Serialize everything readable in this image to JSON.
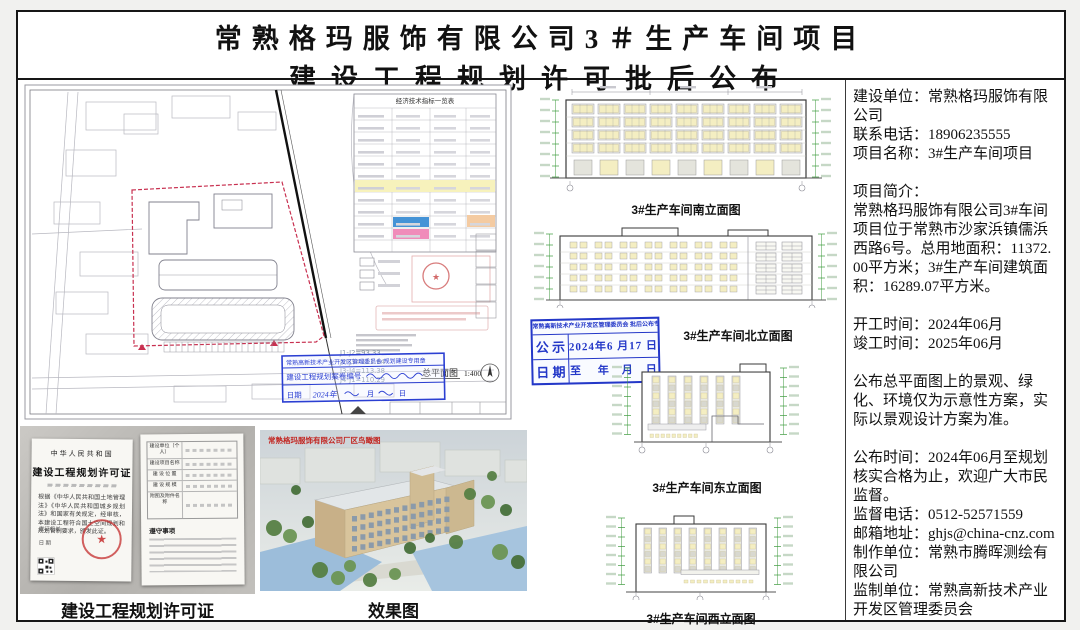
{
  "title": {
    "line1": "常熟格玛服饰有限公司3＃生产车间项目",
    "line2": "建设工程规划许可批后公布"
  },
  "site_plan": {
    "table_title": "经济技术指标一览表",
    "plan_title": "总平面图",
    "plan_scale": "1:400",
    "boundary_dims": [
      "J1-J2=93.33",
      "J2-J3=111.64",
      "J3-J4=113.38",
      "J4-J1=110.29"
    ],
    "blue_stamp": {
      "header": "常熟高新技术产业开发区管理委员会 规划建设专用章",
      "case_label": "建设工程规划案卷编号",
      "date_label": "日期",
      "date_year": "2024年",
      "date_month": "月",
      "date_day": "日"
    }
  },
  "elevations": {
    "south": "3#生产车间南立面图",
    "north": "3#生产车间北立面图",
    "east": "3#生产车间东立面图",
    "west": "3#生产车间西立面图"
  },
  "notice_stamp": {
    "header": "常熟高新技术产业开发区管理委员会 批后公布专用章",
    "r1c1": "公 示",
    "r1c2": "2024年6 月17 日",
    "r2c1": "日 期",
    "r2c2": "至　 年　月　日"
  },
  "certificate": {
    "caption": "建设工程规划许可证",
    "country": "中华人民共和国",
    "doc_title": "建设工程规划许可证",
    "body": "根据《中华人民共和国土地管理法》《中华人民共和国城乡规划法》和国家有关规定，经审核，本建设工程符合国土空间规划和规划管制要求，颁发此证。",
    "issue_label": "发证机关",
    "date_label": "日  期",
    "right_rows": [
      "建设单位（个人）",
      "建设项目名称",
      "建 设 位 置",
      "建 设 规 模",
      "附图及附件名称"
    ],
    "section2": "遵守事项",
    "seal_star": "★"
  },
  "rendering": {
    "caption": "效果图",
    "watermark": "常熟格玛服饰有限公司厂区鸟瞰图"
  },
  "info_panel": {
    "lines": [
      "建设单位：常熟格玛服饰有限公司",
      "联系电话：18906235555",
      "项目名称：3#生产车间项目",
      "",
      "项目简介：",
      "常熟格玛服饰有限公司3#车间项目位于常熟市沙家浜镇儒浜西路6号。总用地面积：11372.00平方米；3#生产车间建筑面积：16289.07平方米。",
      "",
      "开工时间：2024年06月",
      "竣工时间：2025年06月",
      "",
      "公布总平面图上的景观、绿化、环境仅为示意性方案，实际以景观设计方案为准。",
      "",
      "公布时间：2024年06月至规划核实合格为止，欢迎广大市民监督。",
      "监督电话：0512-52571559",
      "邮箱地址：ghjs@china-cnz.com",
      "制作单位：常熟市腾晖测绘有限公司",
      "监制单位：常熟高新技术产业开发区管理委员会"
    ]
  },
  "colors": {
    "stamp_blue": "#2438c8",
    "seal_red": "#c43030",
    "window_yellow": "#f4eec2",
    "marker_green": "#3c9a3c",
    "table_highlight_yellow": "#f7f2bc",
    "table_cell_blue": "#4593d6",
    "table_cell_pink": "#f08cba",
    "table_cell_orange": "#f4cba2",
    "boundary_red": "#c83050"
  }
}
